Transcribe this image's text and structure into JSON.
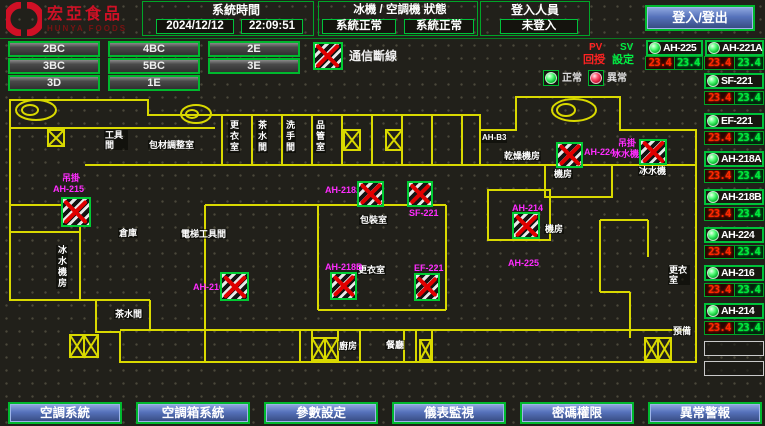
{
  "header": {
    "logo_title": "宏亞食品",
    "logo_subtitle": "HUNYA FOODS",
    "time_label": "系統時間",
    "date": "2024/12/12",
    "time": "22:09:51",
    "status_label": "冰機 / 空調機 狀態",
    "chiller_status": "系統正常",
    "ahu_status": "系統正常",
    "login_label": "登入人員",
    "login_status": "未登入",
    "login_button": "登入/登出"
  },
  "floor_buttons": [
    "2BC",
    "4BC",
    "2E",
    "3BC",
    "5BC",
    "3E",
    "3D",
    "1E"
  ],
  "legend": {
    "comm_loss": "通信斷線",
    "pv": "PV",
    "sv": "SV",
    "feedback": "回授",
    "setpoint": "設定",
    "normal": "正常",
    "abnormal": "異常"
  },
  "units": [
    {
      "name": "AH-225",
      "pv": "23.4",
      "sv": "23.4"
    },
    {
      "name": "AH-221A",
      "pv": "23.4",
      "sv": "23.4"
    },
    {
      "name": "SF-221",
      "pv": "23.4",
      "sv": "23.4"
    },
    {
      "name": "EF-221",
      "pv": "23.4",
      "sv": "23.4"
    },
    {
      "name": "AH-218A",
      "pv": "23.4",
      "sv": "23.4"
    },
    {
      "name": "AH-218B",
      "pv": "23.4",
      "sv": "23.4"
    },
    {
      "name": "AH-224",
      "pv": "23.4",
      "sv": "23.4"
    },
    {
      "name": "AH-216",
      "pv": "23.4",
      "sv": "23.4"
    },
    {
      "name": "AH-214",
      "pv": "23.4",
      "sv": "23.4"
    }
  ],
  "plan": {
    "unit_labels": [
      "吊掛",
      "AH-215",
      "AH-216",
      "AH-218A",
      "SF-221",
      "AH-218B",
      "EF-221",
      "AH-224",
      "吊掛",
      "冰水機",
      "AH-214",
      "AH-225"
    ],
    "room_labels": [
      "工具間",
      "包材調整室",
      "更衣室",
      "茶水間",
      "洗手間",
      "品管室",
      "AH-B3",
      "乾燥機房",
      "機房",
      "冰水機",
      "包裝室",
      "更衣室",
      "倉庫",
      "電梯工具間",
      "茶水間",
      "冰水機房",
      "廚房",
      "餐廳",
      "更衣室",
      "預備",
      "機房"
    ]
  },
  "nav": [
    "空調系統",
    "空調箱系統",
    "參數設定",
    "儀表監視",
    "密碼權限",
    "異常警報"
  ]
}
